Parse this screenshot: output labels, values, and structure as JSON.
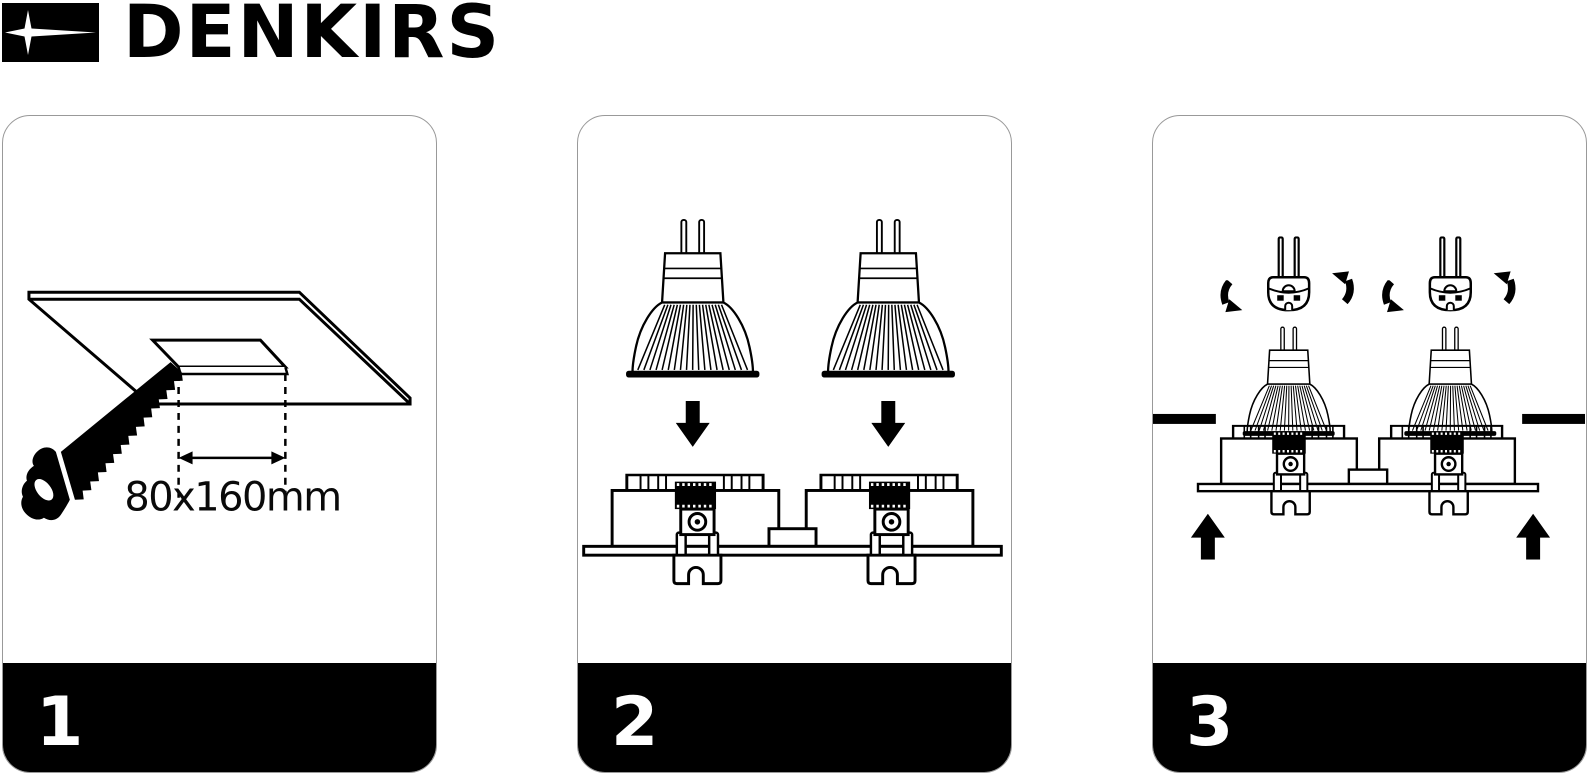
{
  "brand": {
    "name": "DENKIRS",
    "logo_icon": "four-point-star-icon"
  },
  "colors": {
    "line": "#000000",
    "background": "#ffffff",
    "panel_border": "#999999",
    "footer_bg": "#000000",
    "footer_text": "#ffffff"
  },
  "panels": [
    {
      "step_number": "1",
      "dimension_label": "80x160mm",
      "illustration": "saw-cutting-ceiling-opening"
    },
    {
      "step_number": "2",
      "illustration": "two-lamps-lowered-into-twin-fixture"
    },
    {
      "step_number": "3",
      "illustration": "rotate-socket-connectors-push-fixture-into-ceiling"
    }
  ]
}
